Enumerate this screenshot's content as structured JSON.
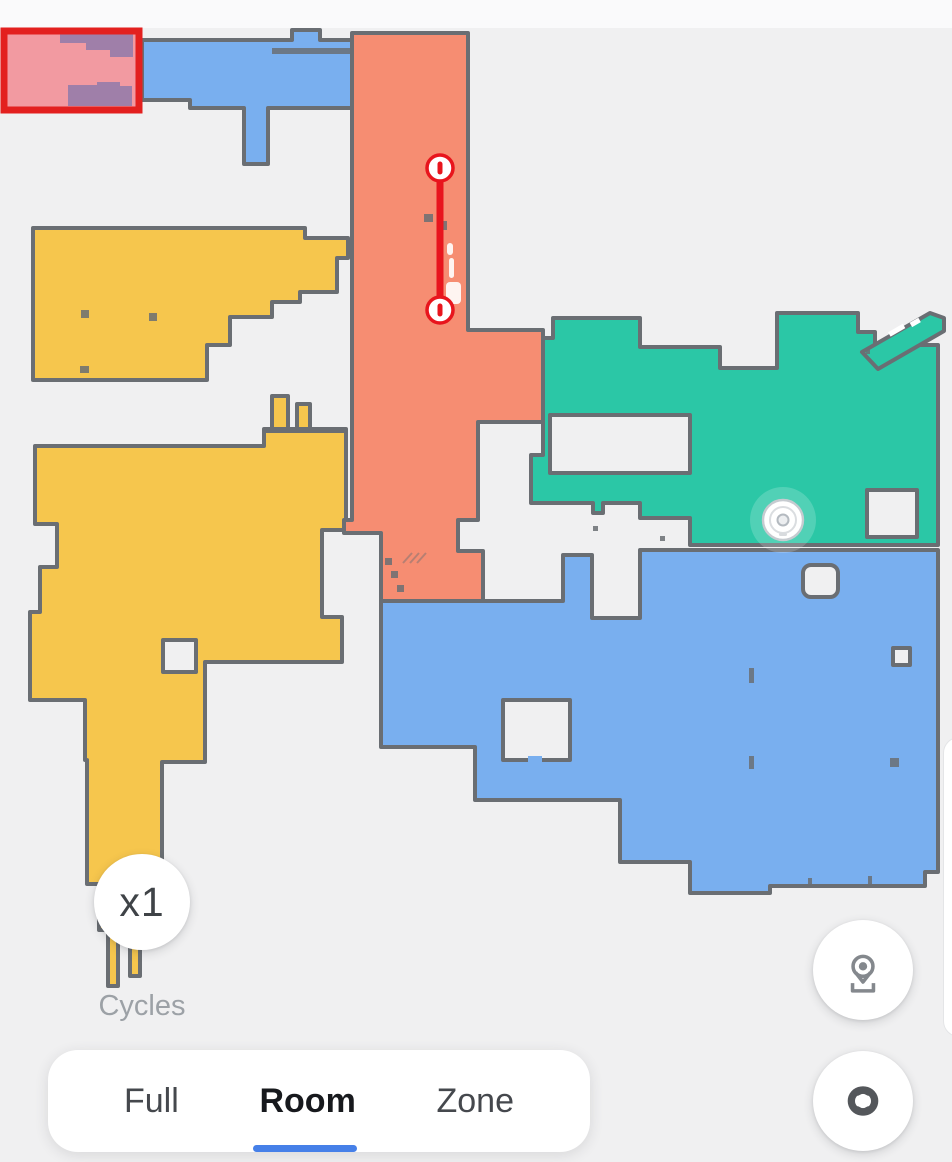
{
  "app": {
    "view": "robot-vacuum-cleaning-map"
  },
  "map": {
    "background": "#F0F0F1",
    "top_strip": "#FAFAFB",
    "wall_color": "#6A6E73",
    "rooms": {
      "blue": "#79AFEF",
      "yellow": "#F6C64D",
      "salmon": "#F68D72",
      "teal": "#2BC7A6"
    },
    "selection": {
      "border": "#E3201F",
      "fill": "#F29AA1",
      "overlap_fill": "#9F7FA9"
    },
    "virtual_wall": {
      "color": "#E8151D"
    },
    "robot": {
      "body": "#FFFFFF",
      "ring": "#C6CBD0"
    }
  },
  "controls": {
    "cycles_button": {
      "label": "x1",
      "text_color": "#3F4347"
    },
    "cycles_caption": {
      "label": "Cycles",
      "text_color": "#9CA1A6"
    },
    "tabs": {
      "items": [
        {
          "label": "Full",
          "active": false
        },
        {
          "label": "Room",
          "active": true
        },
        {
          "label": "Zone",
          "active": false
        }
      ],
      "active_color": "#17191D",
      "inactive_color": "#45484D",
      "underline_color": "#4680E8"
    },
    "locate_button": {
      "icon": "map-pin-icon",
      "icon_color": "#84888D"
    },
    "loop_button": {
      "icon": "interlocked-loops-icon",
      "icon_color": "#54575B"
    }
  }
}
